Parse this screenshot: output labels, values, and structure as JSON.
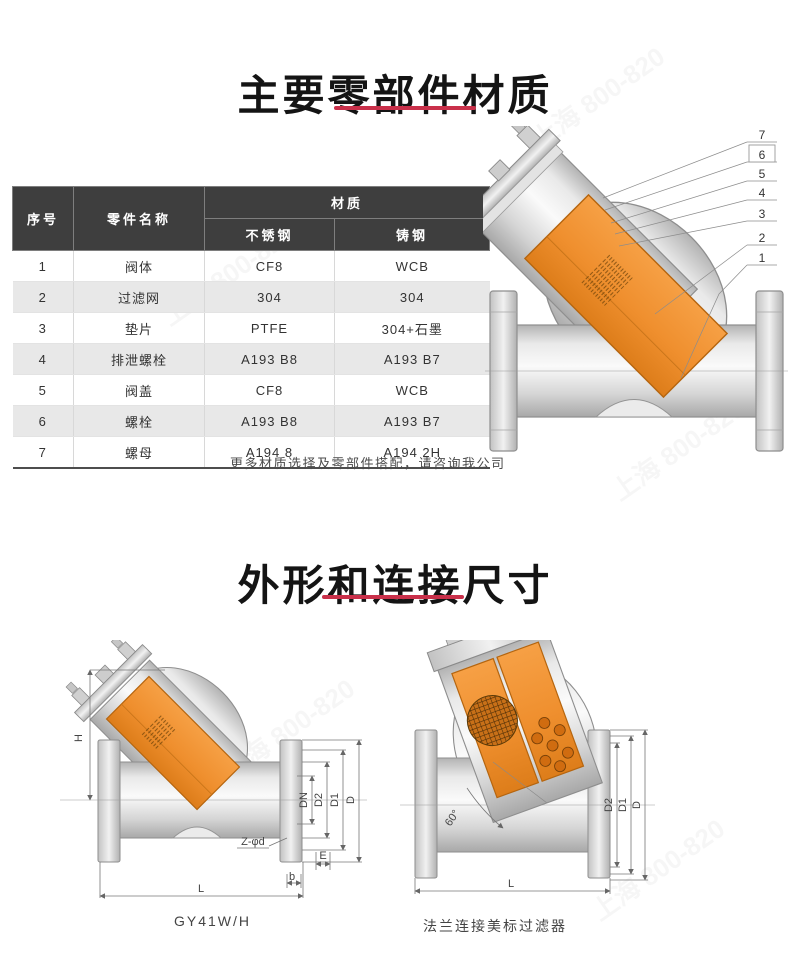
{
  "section_materials": {
    "title": "主要零部件材质",
    "note": "更多材质选择及零部件搭配，请咨询我公司"
  },
  "table": {
    "headers": {
      "no": "序号",
      "part": "零件名称",
      "material": "材质",
      "stainless": "不锈钢",
      "cast": "铸钢"
    },
    "rows": [
      [
        "1",
        "阀体",
        "CF8",
        "WCB"
      ],
      [
        "2",
        "过滤网",
        "304",
        "304"
      ],
      [
        "3",
        "垫片",
        "PTFE",
        "304+石墨"
      ],
      [
        "4",
        "排泄螺栓",
        "A193 B8",
        "A193 B7"
      ],
      [
        "5",
        "阀盖",
        "CF8",
        "WCB"
      ],
      [
        "6",
        "螺栓",
        "A193 B8",
        "A193 B7"
      ],
      [
        "7",
        "螺母",
        "A194 8",
        "A194 2H"
      ]
    ]
  },
  "section_diagram": {
    "callouts": [
      "7",
      "6",
      "5",
      "4",
      "3",
      "2",
      "1"
    ],
    "boxed_callout": "6"
  },
  "section_dimensions": {
    "title": "外形和连接尺寸"
  },
  "drawing_left": {
    "caption": "GY41W/H",
    "dims": {
      "h": "H",
      "dn": "DN",
      "d2": "D2",
      "d1": "D1",
      "d": "D",
      "zd": "Z-φd",
      "e": "E",
      "b": "b",
      "l": "L"
    }
  },
  "drawing_right": {
    "caption": "法兰连接美标过滤器",
    "dims": {
      "angle": "60°",
      "d2": "D2",
      "d1": "D1",
      "d": "D",
      "l": "L"
    }
  },
  "colors": {
    "accent_red": "#c9304a",
    "strainer_orange": "#ef8f2e",
    "table_header_bg": "#3e3e3e",
    "table_row_alt": "#e8e8e8"
  },
  "watermark": {
    "text": "上海 800-820"
  }
}
